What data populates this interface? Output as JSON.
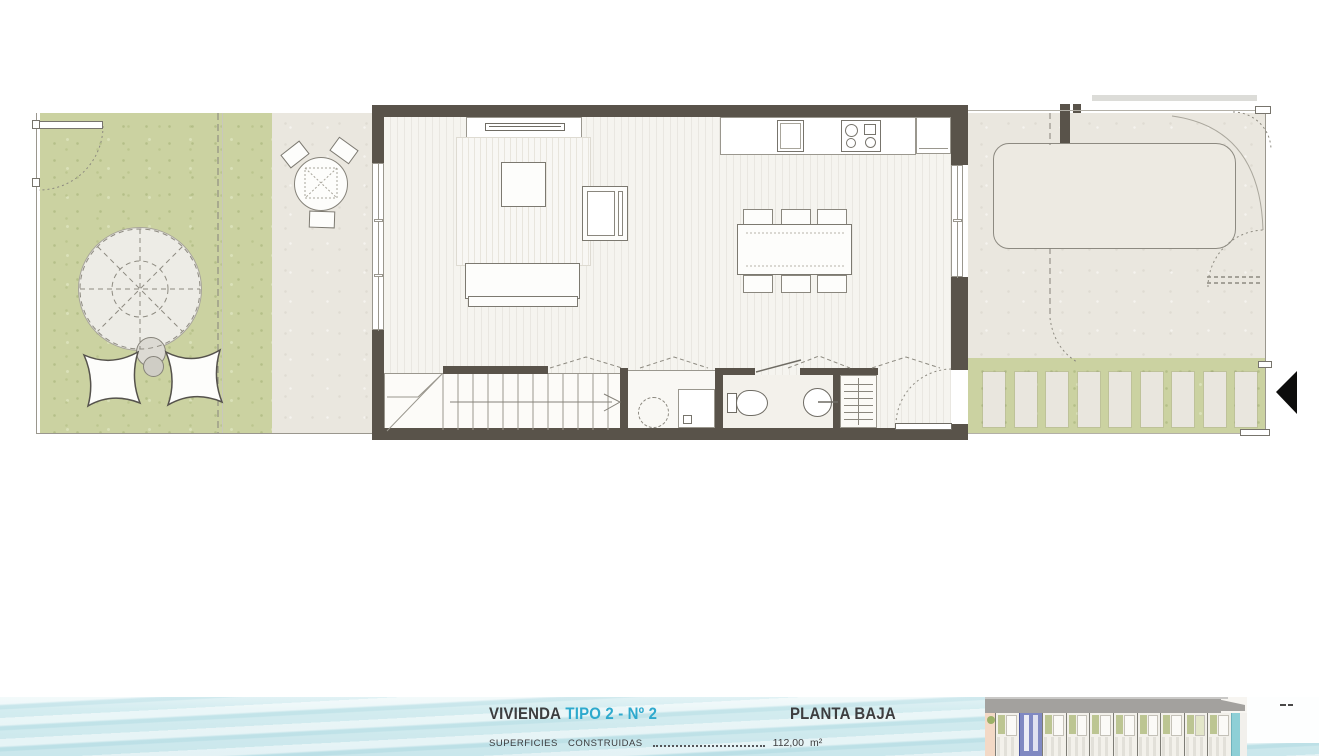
{
  "footer": {
    "unit_label": "VIVIENDA",
    "unit_type": "TIPO 2 - Nº 2",
    "floor_label": "PLANTA BAJA",
    "surface_label": "SUPERFICIES  CONSTRUIDAS",
    "surface_value": "112,00",
    "surface_unit": "m²"
  },
  "colors": {
    "wall": "#59534a",
    "grass_green": "#cbd2a1",
    "paving_beige": "#eae7df",
    "water_blue": "#cfe9ed",
    "accent_cyan": "#2ea9cd",
    "text_dark": "#3d3d3f",
    "highlight_unit_blue": "#8089c2",
    "pool_teal": "#8ecfd6",
    "road_gray": "#a3a19e",
    "entrance_arrow_black": "#0d0d0c"
  },
  "icons": {
    "entrance_arrow": "left-pointing solid triangle marking the plot entrance"
  }
}
